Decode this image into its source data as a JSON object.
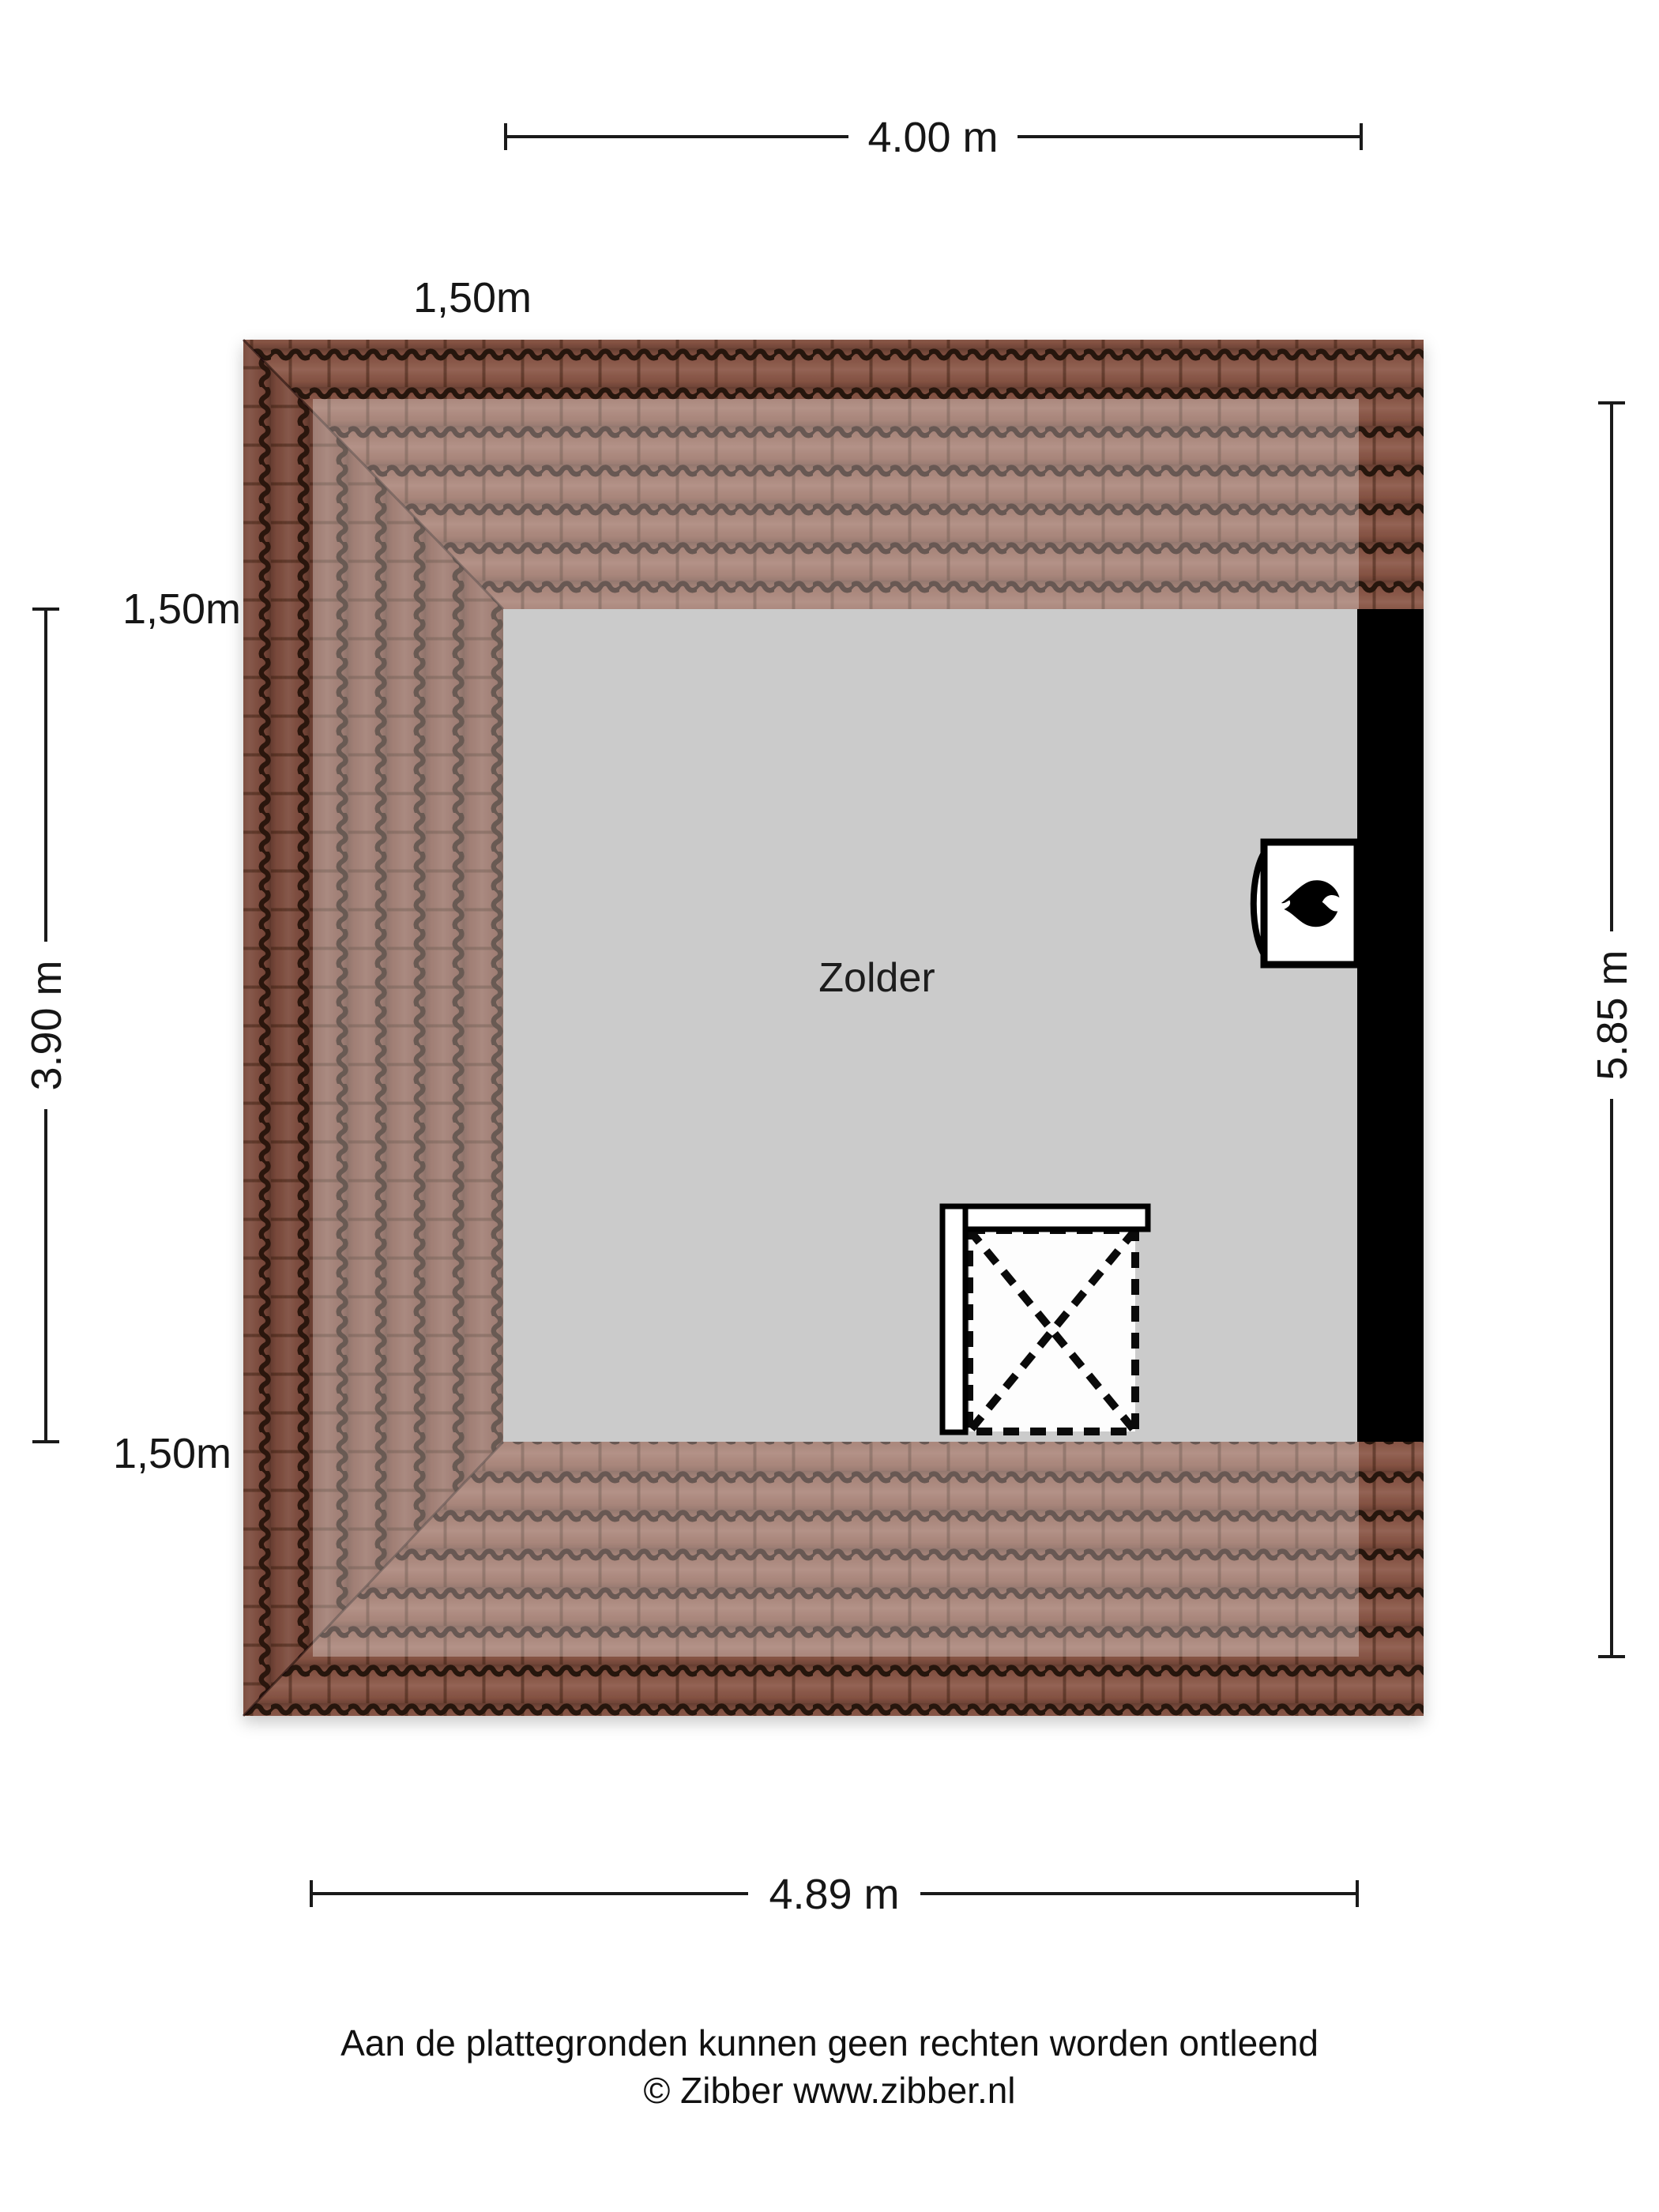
{
  "title": "Zolder plattegrond",
  "floorplan": {
    "room": {
      "label": "Zolder",
      "floor_color": "#cbcbcb"
    },
    "roof": {
      "tile_color": "#8a5646",
      "tile_joint_color": "#26120a",
      "low_headroom_overlay": "rgba(255,255,255,0.30)"
    },
    "wall_color": "#000000",
    "dimensions": {
      "width_top": "4.00 m",
      "width_bottom": "4.89 m",
      "depth_left": "3.90 m",
      "depth_right": "5.85 m"
    },
    "height_markers": {
      "top": "1,50m",
      "left": "1,50m",
      "bottom": "1,50m"
    },
    "symbols": {
      "heater": "flame-icon",
      "stair_opening": "dashed-cross-opening"
    }
  },
  "footer": {
    "disclaimer": "Aan de plattegronden kunnen geen rechten worden ontleend",
    "copyright": "© Zibber www.zibber.nl"
  }
}
